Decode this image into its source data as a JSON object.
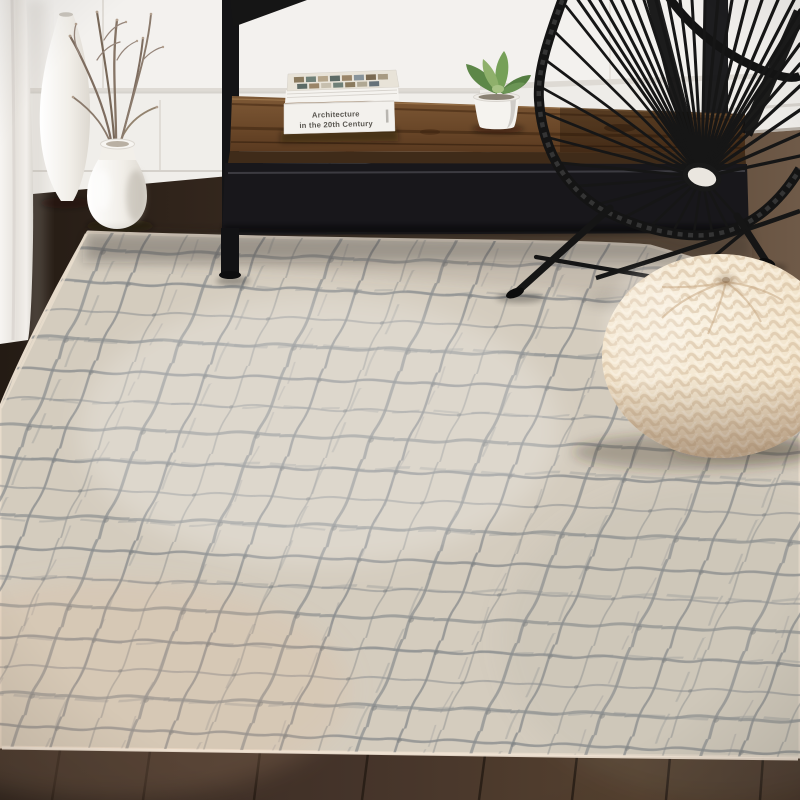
{
  "scene": {
    "title": "Area rug product photo",
    "room": "living room corner with white wainscoted wall and dark wood plank floor",
    "book": {
      "spine_line1": "Architecture",
      "spine_line2": "in the 20th Century"
    },
    "objects": {
      "rug": "beige and gray abstract crosshatch area rug",
      "chair": "black Acapulco woven cord chair",
      "pouf": "cream chunky knit round pouf",
      "console": "black metal console with reclaimed wood shelf",
      "books": "two stacked architecture books",
      "plant": "green succulent in white round pot",
      "tall_vase": "tall white ceramic vase",
      "round_vase": "round white ceramic vase holding dry branches",
      "curtain": "white curtain panel at left edge"
    },
    "palette": {
      "wall": "#f3f1ee",
      "wainscot_line": "#d9d5cf",
      "floor_dark": "#2c211a",
      "floor_light": "#6e5947",
      "rug_base": "#d4ccbe",
      "rug_line": "#83878a",
      "rug_warm_edge": "#e0c3a8",
      "chair_black": "#141414",
      "pouf_cream": "#f2e5d0",
      "wood_brown": "#6e4a2c",
      "ceramic_white": "#f6f4f0"
    }
  }
}
